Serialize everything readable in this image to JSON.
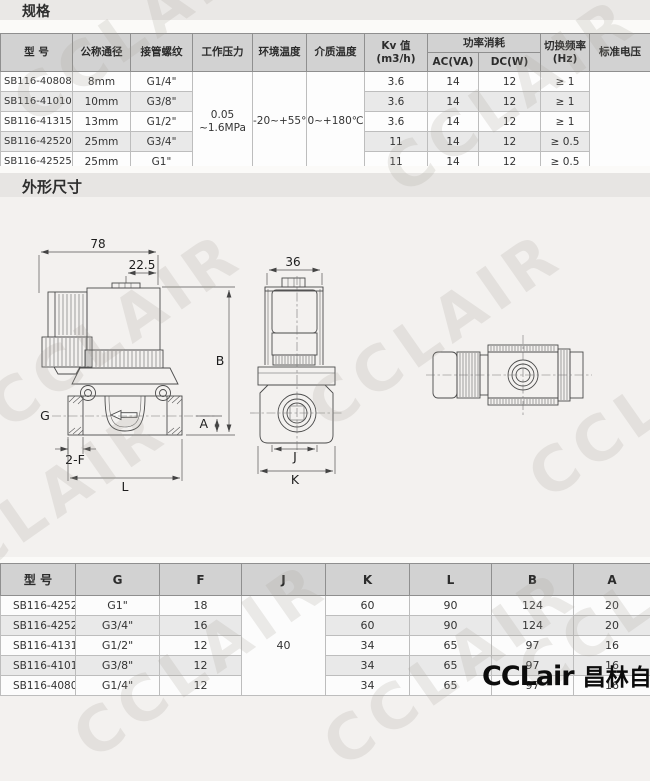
{
  "page": {
    "section1_title": "规格",
    "section2_title": "外形尺寸",
    "watermark_text": "CCLAIR",
    "logo_latin": "CCLair",
    "logo_cjk": "昌林自动化",
    "colors": {
      "header_bg": "#d2d2d2",
      "stripe_bg": "#e9e9e9",
      "bar_bg": "#e7e5e3"
    }
  },
  "spec_table": {
    "headers": {
      "model": "型  号",
      "diameter": "公称通径",
      "thread": "接管螺纹",
      "pressure": "工作压力",
      "ambient": "环境温度",
      "media": "介质温度",
      "kv_line1": "Kv 值",
      "kv_line2": "(m3/h)",
      "power": "功率消耗",
      "ac": "AC(VA)",
      "dc": "DC(W)",
      "freq_line1": "切换频率",
      "freq_line2": "(Hz)",
      "voltage": "标准电压"
    },
    "merged": {
      "pressure_line1": "0.05",
      "pressure_line2": "~1.6MPa",
      "ambient": "-20~+55℃",
      "media": "0~+180℃"
    },
    "rows": [
      {
        "model": "SB116-40808",
        "dn": "8mm",
        "thread": "G1/4\"",
        "kv": "3.6",
        "ac": "14",
        "dc": "12",
        "freq": "≥ 1"
      },
      {
        "model": "SB116-41010",
        "dn": "10mm",
        "thread": "G3/8\"",
        "kv": "3.6",
        "ac": "14",
        "dc": "12",
        "freq": "≥ 1"
      },
      {
        "model": "SB116-41315",
        "dn": "13mm",
        "thread": "G1/2\"",
        "kv": "3.6",
        "ac": "14",
        "dc": "12",
        "freq": "≥ 1"
      },
      {
        "model": "SB116-42520",
        "dn": "25mm",
        "thread": "G3/4\"",
        "kv": "11",
        "ac": "14",
        "dc": "12",
        "freq": "≥ 0.5"
      },
      {
        "model": "SB116-42525",
        "dn": "25mm",
        "thread": "G1\"",
        "kv": "11",
        "ac": "14",
        "dc": "12",
        "freq": "≥ 0.5"
      }
    ]
  },
  "dim_table": {
    "headers": [
      "型  号",
      "G",
      "F",
      "J",
      "K",
      "L",
      "B",
      "A"
    ],
    "merged_j": "40",
    "rows": [
      {
        "model": "SB116-42525",
        "g": "G1\"",
        "f": "18",
        "k": "60",
        "l": "90",
        "b": "124",
        "a": "20"
      },
      {
        "model": "SB116-42520",
        "g": "G3/4\"",
        "f": "16",
        "k": "60",
        "l": "90",
        "b": "124",
        "a": "20"
      },
      {
        "model": "SB116-41315",
        "g": "G1/2\"",
        "f": "12",
        "k": "34",
        "l": "65",
        "b": "97",
        "a": "16"
      },
      {
        "model": "SB116-41010",
        "g": "G3/8\"",
        "f": "12",
        "k": "34",
        "l": "65",
        "b": "97",
        "a": "16"
      },
      {
        "model": "SB116-40808",
        "g": "G1/4\"",
        "f": "12",
        "k": "34",
        "l": "65",
        "b": "97",
        "a": "16"
      }
    ]
  },
  "drawing": {
    "labels": {
      "d78": "78",
      "d225": "22.5",
      "d36": "36",
      "B": "B",
      "A": "A",
      "G": "G",
      "F2": "2-F",
      "L": "L",
      "J": "J",
      "K": "K"
    }
  }
}
